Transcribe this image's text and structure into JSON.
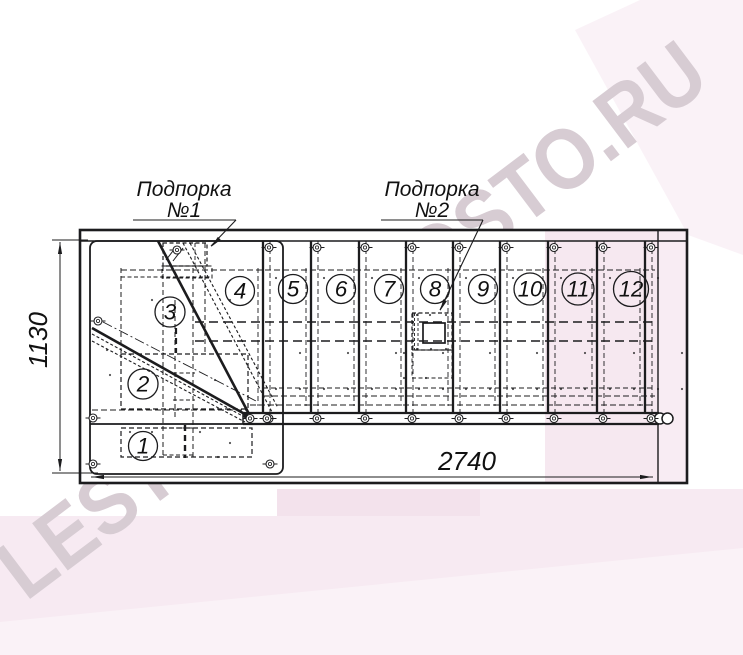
{
  "watermark": {
    "text": "LESTNICY-PROSTO.RU"
  },
  "drawing": {
    "type": "staircase-plan-view",
    "callouts": [
      {
        "label": "Подпорка",
        "number": "№1"
      },
      {
        "label": "Подпорка",
        "number": "№2"
      }
    ],
    "dimensions": {
      "horizontal": "2740",
      "vertical": "1130"
    },
    "step_numbers": [
      "1",
      "2",
      "3",
      "4",
      "5",
      "6",
      "7",
      "8",
      "9",
      "10",
      "11",
      "12"
    ]
  },
  "colors": {
    "line": "#1c1c1e",
    "pink_band": "#f7eaf2",
    "pink_block": "#f3e2ec",
    "pink_light": "#faf2f7",
    "pink_inside": "#f6e8f0",
    "watermark": "#d7ccd3"
  }
}
